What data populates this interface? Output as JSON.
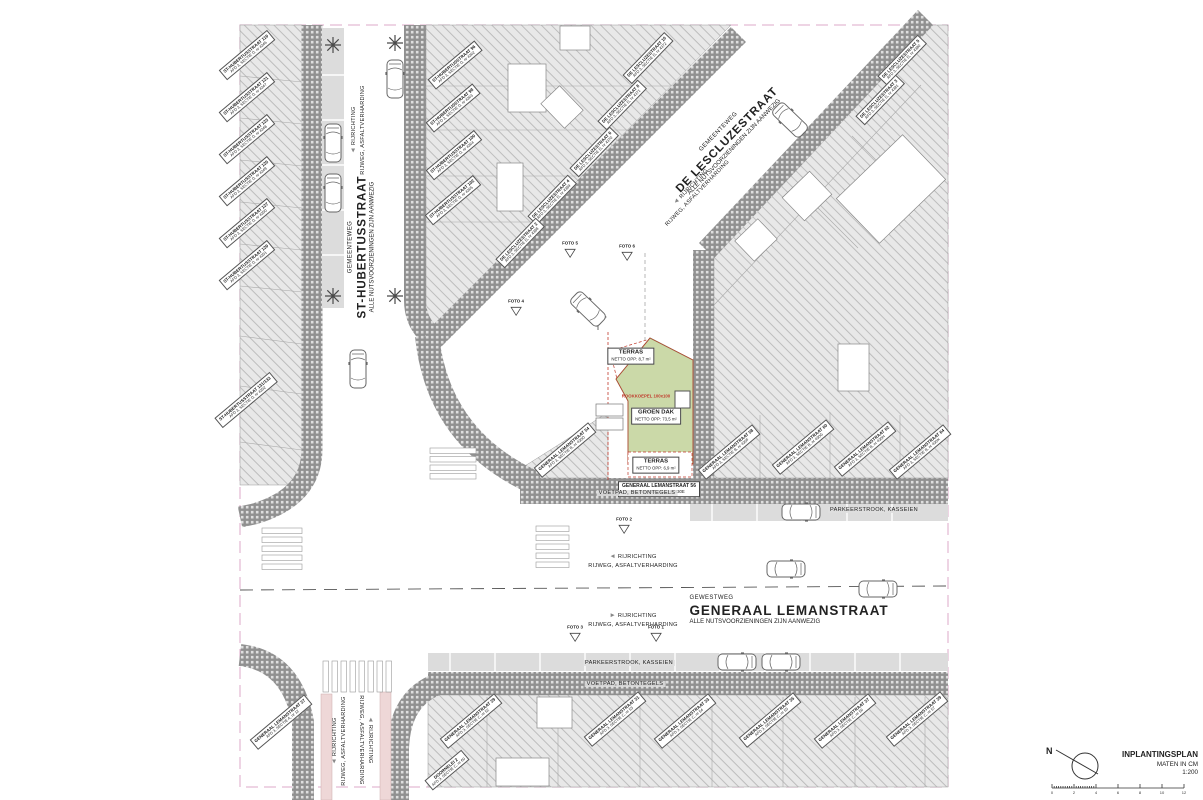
{
  "plan": {
    "legend": {
      "title": "INPLANTINGSPLAN",
      "units": "MATEN IN CM",
      "scale": "1:200",
      "north": "N",
      "scalebar_numbers": [
        "0",
        "2",
        "4",
        "6",
        "8",
        "10",
        "12"
      ]
    },
    "streets": {
      "st_hubertus": {
        "category": "GEMEENTEWEG",
        "name": "ST-HUBERTUSSTRAAT",
        "utilities": "ALLE NUTSVOORZIENINGEN ZIJN AANWEZIG"
      },
      "de_lescluze": {
        "category": "GEMEENTEWEG",
        "name": "DE LESCLUZESTRAAT",
        "utilities": "ALLE NUTSVOORZIENINGEN ZIJN AANWEZIG"
      },
      "generaal_leman": {
        "category": "GEWESTWEG",
        "name": "GENERAAL LEMANSTRAAT",
        "utilities": "ALLE NUTSVOORZIENINGEN ZIJN AANWEZIG"
      }
    },
    "road_texts": {
      "direction": "RIJRICHTING",
      "surface": "RIJWEG, ASFALTVERHARDING",
      "parking": "PARKEERSTROOK, KASSEIEN",
      "sidewalk": "VOETPAD, BETONTEGELS"
    },
    "site": {
      "roof": "GROEN DAK",
      "roof_area": "NETTO OPP: 73,5 m²",
      "terrace": "TERRAS",
      "terrace_top_area": "NETTO OPP: 8,7 m²",
      "terrace_bottom_area": "NETTO OPP: 6,9 m²",
      "skylight": "ROOKKOEPEL 100x100",
      "address": "GENERAAL LEMANSTRAAT 56",
      "cadastre": "AFD 3, SECTIE B, nr 430E"
    },
    "colors": {
      "roof_green": "#cbd9a8",
      "site_red": "#c0392b",
      "boundary_pink": "#dca8c8",
      "hatch_bg": "#e8e8e8",
      "sidewalk_gray": "#909090",
      "parking_gray": "#dcdcdc",
      "b ike_path_pink": "#eed7d7"
    }
  },
  "parcel_labels": [
    {
      "l1": "ST-HUBERTUSSTRAAT 119",
      "l2": "AFD 3, SECTIE D, nr 4346",
      "x": 247,
      "y": 55,
      "r": -40
    },
    {
      "l1": "ST-HUBERTUSSTRAAT 121",
      "l2": "AFD 3, SECTIE D, nr 4347",
      "x": 247,
      "y": 97,
      "r": -40
    },
    {
      "l1": "ST-HUBERTUSSTRAAT 123",
      "l2": "AFD 3, SECTIE D, nr 4348",
      "x": 247,
      "y": 139,
      "r": -40
    },
    {
      "l1": "ST-HUBERTUSSTRAAT 125",
      "l2": "AFD 3, SECTIE D, nr 4349",
      "x": 247,
      "y": 181,
      "r": -40
    },
    {
      "l1": "ST-HUBERTUSSTRAAT 127",
      "l2": "AFD 3, SECTIE D, nr 4350",
      "x": 247,
      "y": 223,
      "r": -40
    },
    {
      "l1": "ST-HUBERTUSSTRAAT 129",
      "l2": "AFD 3, SECTIE D, nr 4351",
      "x": 247,
      "y": 265,
      "r": -40
    },
    {
      "l1": "ST-HUBERTUSSTRAAT 131/133",
      "l2": "AFD 3, SECTIE D, nr 4352",
      "x": 246,
      "y": 400,
      "r": -40
    },
    {
      "l1": "ST-HUBERTUSSTRAAT 96",
      "l2": "AFD 3, SECTIE D, nr 4362",
      "x": 455,
      "y": 65,
      "r": -40
    },
    {
      "l1": "ST-HUBERTUSSTRAAT 98",
      "l2": "AFD 3, SECTIE D, nr 4363",
      "x": 453,
      "y": 108,
      "r": -40
    },
    {
      "l1": "ST-HUBERTUSSTRAAT 100",
      "l2": "AFD 3, SECTIE D, nr 4364",
      "x": 454,
      "y": 155,
      "r": -40
    },
    {
      "l1": "ST-HUBERTUSSTRAAT 102",
      "l2": "AFD 3, SECTIE D, nr 4365",
      "x": 453,
      "y": 200,
      "r": -40
    },
    {
      "l1": "DE LESCLUZESTRAAT 10",
      "l2": "AFD 3, SECTIE D, nr 4372",
      "x": 648,
      "y": 58,
      "r": -46
    },
    {
      "l1": "DE LESCLUZESTRAAT 8",
      "l2": "AFD 3, SECTIE D, nr 4371",
      "x": 622,
      "y": 105,
      "r": -46
    },
    {
      "l1": "DE LESCLUZESTRAAT 6",
      "l2": "AFD 3, SECTIE D, nr 4370",
      "x": 594,
      "y": 152,
      "r": -46
    },
    {
      "l1": "DE LESCLUZESTRAAT 4",
      "l2": "AFD 3, SECTIE D, nr 4369",
      "x": 552,
      "y": 200,
      "r": -46
    },
    {
      "l1": "DE LESCLUZESTRAAT 2",
      "l2": "AFD 3, SECTIE D, nr 4368",
      "x": 520,
      "y": 243,
      "r": -46
    },
    {
      "l1": "DE LESCLUZESTRAAT 5",
      "l2": "AFD 3, SECTIE D, nr 4380",
      "x": 902,
      "y": 60,
      "r": -46
    },
    {
      "l1": "DE LESCLUZESTRAAT 3",
      "l2": "AFD 3, SECTIE D, nr 4381",
      "x": 880,
      "y": 100,
      "r": -46
    },
    {
      "l1": "GENERAAL LEMANSTRAAT 54",
      "l2": "AFD 3, SECTIE B, nr 430D",
      "x": 565,
      "y": 450,
      "r": -40
    },
    {
      "l1": "GENERAAL LEMANSTRAAT 58",
      "l2": "AFD 3, SECTIE B, nr 430F",
      "x": 729,
      "y": 452,
      "r": -40
    },
    {
      "l1": "GENERAAL LEMANSTRAAT 60",
      "l2": "AFD 3, SECTIE B, nr 430G",
      "x": 803,
      "y": 447,
      "r": -40
    },
    {
      "l1": "GENERAAL LEMANSTRAAT 62",
      "l2": "AFD 3, SECTIE B, nr 430H",
      "x": 865,
      "y": 449,
      "r": -40
    },
    {
      "l1": "GENERAAL LEMANSTRAAT 64",
      "l2": "AFD 3, SECTIE B, nr 430K",
      "x": 920,
      "y": 452,
      "r": -40
    },
    {
      "l1": "GENERAAL LEMANSTRAAT 29",
      "l2": "AFD 3, SECTIE C, nr 52",
      "x": 471,
      "y": 721,
      "r": -40
    },
    {
      "l1": "GENERAAL LEMANSTRAAT 31",
      "l2": "AFD 3, SECTIE C, nr 53",
      "x": 615,
      "y": 719,
      "r": -40
    },
    {
      "l1": "GENERAAL LEMANSTRAAT 33",
      "l2": "AFD 3, SECTIE C, nr 54",
      "x": 685,
      "y": 721,
      "r": -40
    },
    {
      "l1": "GENERAAL LEMANSTRAAT 35",
      "l2": "AFD 3, SECTIE C, nr 55",
      "x": 770,
      "y": 720,
      "r": -40
    },
    {
      "l1": "GENERAAL LEMANSTRAAT 37",
      "l2": "AFD 3, SECTIE C, nr 56",
      "x": 845,
      "y": 721,
      "r": -40
    },
    {
      "l1": "GENERAAL LEMANSTRAAT 39",
      "l2": "AFD 3, SECTIE C, nr 57",
      "x": 917,
      "y": 719,
      "r": -40
    },
    {
      "l1": "DOORNELEI 2",
      "l2": "AFD 3, SECTIE C, nr 60",
      "x": 447,
      "y": 770,
      "r": -40
    },
    {
      "l1": "GENERAAL LEMANSTRAAT 27",
      "l2": "AFD 3, SECTIE A, nr 12",
      "x": 281,
      "y": 722,
      "r": -40
    }
  ],
  "direction_labels": [
    {
      "x": 358,
      "y": 130,
      "r": -90,
      "arrow": "left"
    },
    {
      "x": 694,
      "y": 190,
      "r": -46,
      "arrow": "left"
    },
    {
      "x": 633,
      "y": 561,
      "r": 0,
      "arrow": "left"
    },
    {
      "x": 633,
      "y": 620,
      "r": 0,
      "arrow": "right"
    },
    {
      "x": 339,
      "y": 741,
      "r": -90,
      "arrow": "left"
    },
    {
      "x": 366,
      "y": 740,
      "r": 90,
      "arrow": "left"
    }
  ],
  "band_texts": [
    {
      "key": "sidewalk",
      "x": 637,
      "y": 493
    },
    {
      "key": "parking",
      "x": 874,
      "y": 510
    },
    {
      "key": "parking",
      "x": 629,
      "y": 663
    },
    {
      "key": "sidewalk",
      "x": 625,
      "y": 684
    }
  ],
  "photo_markers": [
    {
      "label": "FOTO 4",
      "x": 516,
      "y": 310
    },
    {
      "label": "FOTO 5",
      "x": 570,
      "y": 252
    },
    {
      "label": "FOTO 6",
      "x": 627,
      "y": 255
    },
    {
      "label": "FOTO 2",
      "x": 624,
      "y": 528
    },
    {
      "label": "FOTO 3",
      "x": 575,
      "y": 636
    },
    {
      "label": "FOTO 1",
      "x": 656,
      "y": 636
    }
  ]
}
